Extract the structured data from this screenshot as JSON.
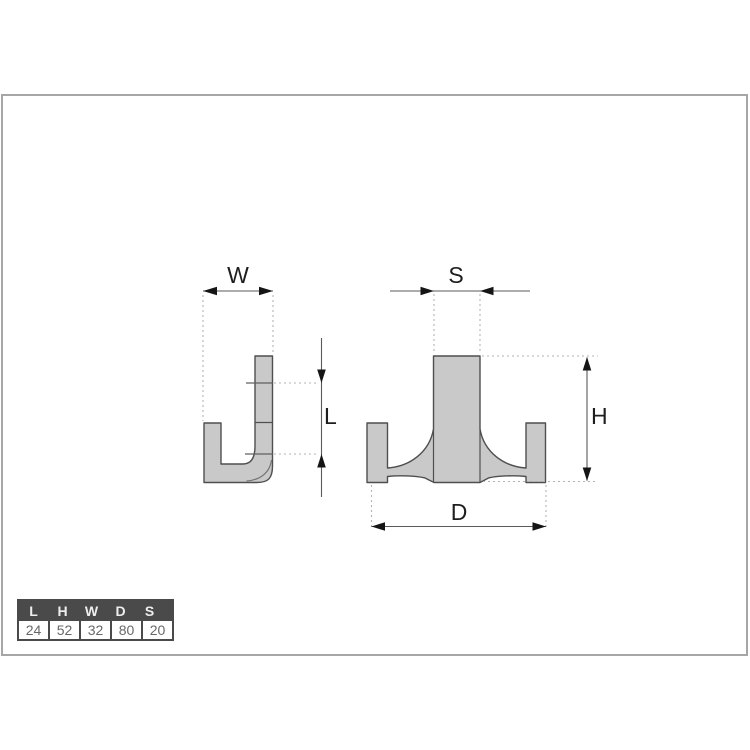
{
  "diagram": {
    "title": "double hook technical drawing",
    "side_view": {
      "name": "hook-side-view",
      "labels": {
        "width": "W",
        "length": "L"
      }
    },
    "front_view": {
      "name": "hook-front-view",
      "labels": {
        "spacing": "S",
        "height": "H",
        "depth": "D"
      }
    },
    "colors": {
      "part_fill": "#c9c9c9",
      "part_stroke": "#4f4f4f",
      "dim_line": "#5a5a5a",
      "arrow": "#151515",
      "dotted": "#b3b3b3",
      "label": "#1e1e1e",
      "frame_border": "#a6a6a6"
    }
  },
  "dimensions_table": {
    "headers": [
      "L",
      "H",
      "W",
      "D",
      "S"
    ],
    "values": [
      "24",
      "52",
      "32",
      "80",
      "20"
    ],
    "header_bg": "#4a4a4a",
    "header_text_color": "#eeeeee",
    "value_text_color": "#686868",
    "border_color": "#4a4a4a"
  }
}
